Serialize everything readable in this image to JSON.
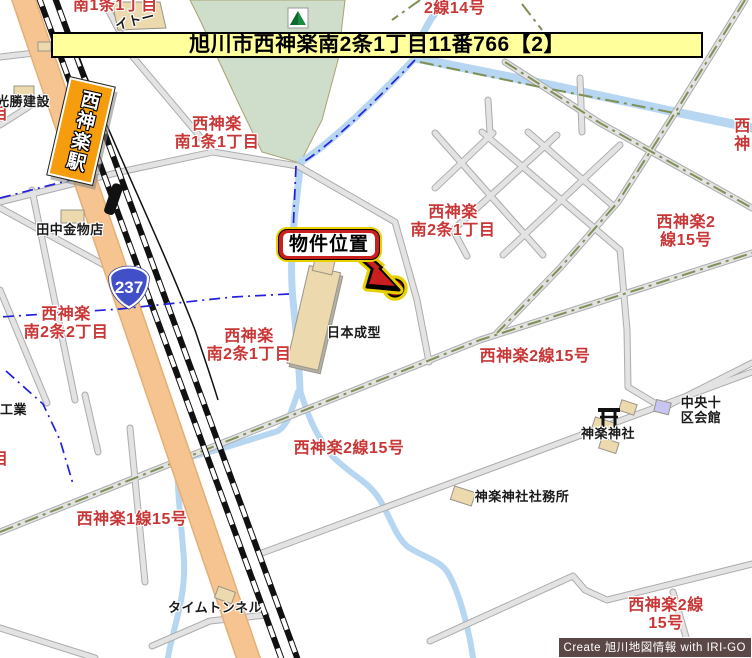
{
  "banner": {
    "text": "旭川市西神楽南2条1丁目11番766【2】"
  },
  "marker": {
    "label": "物件位置"
  },
  "station": {
    "name": "西神楽駅"
  },
  "route_shield": {
    "number": "237"
  },
  "credit": {
    "text": "Create 旭川地図情報 with IRI-GO"
  },
  "area_labels": [
    {
      "text": "南1条1丁目"
    },
    {
      "text": "2線14号"
    },
    {
      "text": "西神楽\n南1条1丁目"
    },
    {
      "text": "西神楽\n南2条1丁目"
    },
    {
      "text": "西神楽2線15号"
    },
    {
      "text": "西神"
    },
    {
      "text": "西神楽\n南2条2丁目"
    },
    {
      "text": "西神楽\n南2条1丁目"
    },
    {
      "text": "西神楽2線15号"
    },
    {
      "text": "西神楽2線15号"
    },
    {
      "text": "西神楽1線15号"
    },
    {
      "text": "西神楽2線15号"
    },
    {
      "text": "目"
    },
    {
      "text": "目"
    }
  ],
  "place_labels": [
    {
      "text": "イトー"
    },
    {
      "text": "光勝建設"
    },
    {
      "text": "田中金物店"
    },
    {
      "text": "日本成型"
    },
    {
      "text": "タイムトンネル"
    },
    {
      "text": "神楽神社"
    },
    {
      "text": "中央十区会館"
    },
    {
      "text": "神楽神社社務所"
    },
    {
      "text": "工業"
    }
  ],
  "colors": {
    "banner_bg": "#FFFF9C",
    "area_label_red": "#C93636",
    "park_green": "#CFDECB",
    "water_blue": "#B7D6F2",
    "road_fill": "#E3E3E3",
    "road_casing": "#ACACAC",
    "route_road_orange": "#F6C491",
    "boundary_blue": "#2020DD",
    "boundary_olive": "#7E9055",
    "marker_red": "#C91F1F",
    "marker_yellow": "#E7CF00",
    "station_orange": "#F59D0C",
    "shield_blue": "#4150C8",
    "building_tan": "#EDD9AE",
    "hall_purple": "#C9C5F2",
    "credit_bg": "#5C4747"
  }
}
